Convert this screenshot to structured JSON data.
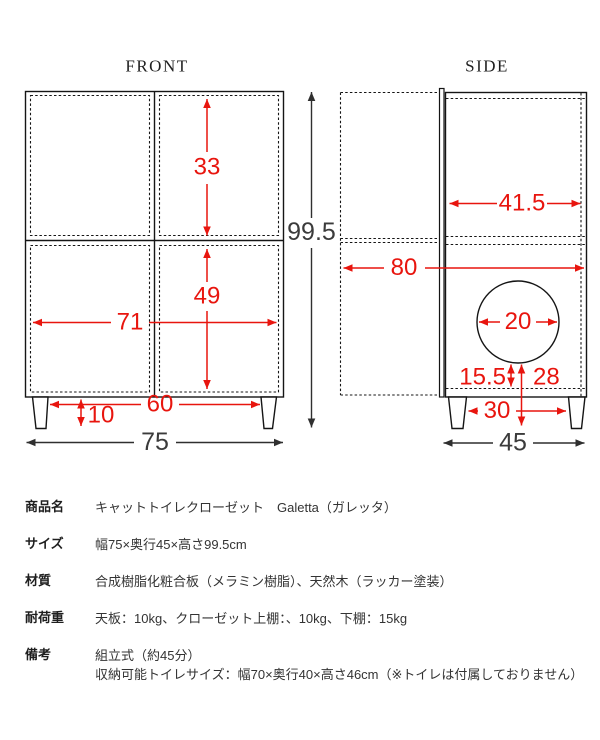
{
  "colors": {
    "dimension_red": "#e8150e",
    "dimension_dark": "#3b3b3b",
    "line_black": "#151515"
  },
  "front": {
    "title": "FRONT",
    "inner_top_height": "33",
    "inner_bottom_height": "49",
    "inner_width": "71",
    "leg_inner_span": "60",
    "leg_height": "10",
    "total_width": "75",
    "total_height": "99.5"
  },
  "side": {
    "title": "SIDE",
    "inner_depth": "41.5",
    "depth_door_open": "80",
    "hole_diameter": "20",
    "hole_bottom_from_shelf": "15.5",
    "hole_bottom_from_floor": "28",
    "leg_inner_span": "30",
    "total_depth": "45"
  },
  "spec_table": {
    "rows": [
      {
        "label": "商品名",
        "value": "キャットトイレクローゼット　Galetta（ガレッタ）"
      },
      {
        "label": "サイズ",
        "value": "幅75×奥行45×高さ99.5cm"
      },
      {
        "label": "材質",
        "value": "合成樹脂化粧合板（メラミン樹脂）、天然木（ラッカー塗装）"
      },
      {
        "label": "耐荷重",
        "value": "天板：10kg、クローゼット上棚：、10kg、下棚：15kg"
      },
      {
        "label": "備考",
        "value": "組立式（約45分）\n収納可能トイレサイズ：幅70×奥行40×高さ46cm（※トイレは付属しておりません）"
      }
    ]
  }
}
